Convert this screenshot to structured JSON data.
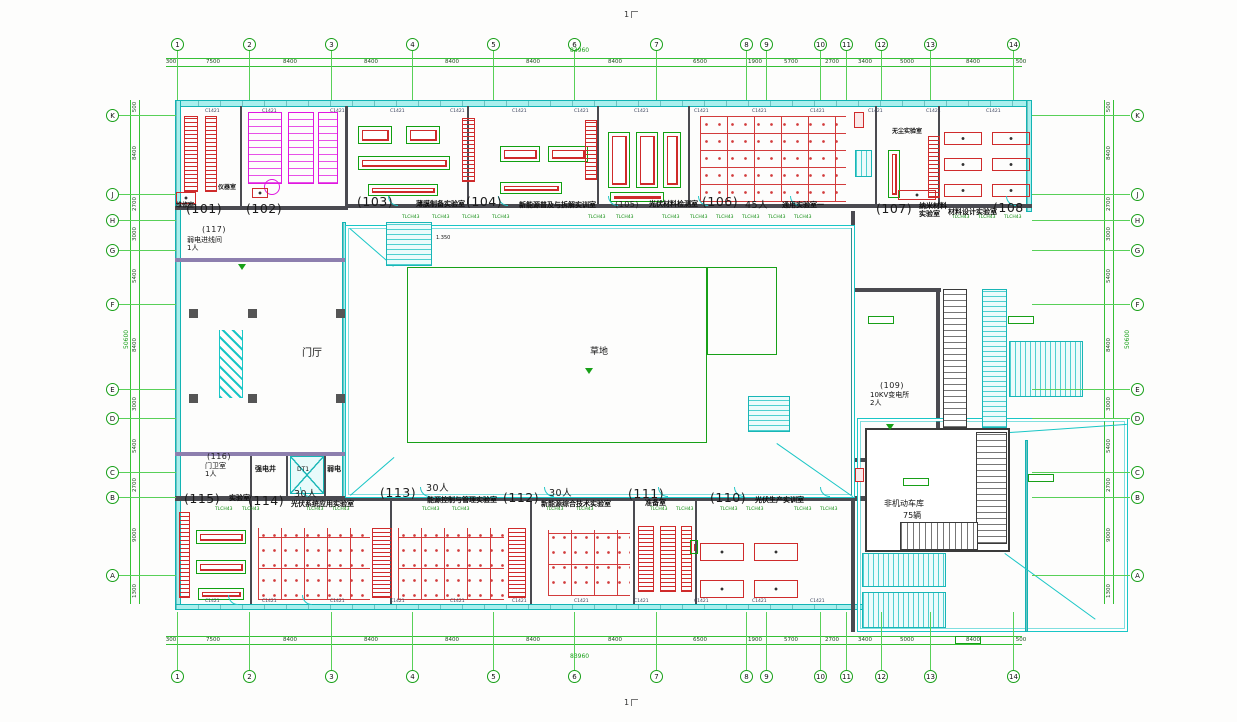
{
  "meta": {
    "sheet_mark_top": "1",
    "sheet_mark_bottom": "1"
  },
  "drawing_totals": {
    "overall_width": "83960",
    "overall_height": "50600"
  },
  "grid": {
    "top_labels": [
      "1",
      "2",
      "3",
      "4",
      "5",
      "6",
      "7",
      "8",
      "9",
      "10",
      "11",
      "12",
      "13",
      "14"
    ],
    "top_x": [
      177,
      249,
      331,
      412,
      493,
      574,
      656,
      746,
      766,
      820,
      846,
      881,
      930,
      1013
    ],
    "side_labels": [
      "K",
      "J",
      "H",
      "G",
      "F",
      "E",
      "D",
      "C",
      "B",
      "A"
    ],
    "side_y": [
      115,
      194,
      220,
      250,
      304,
      389,
      418,
      472,
      497,
      575
    ],
    "top_dims": [
      [
        "300",
        171
      ],
      [
        "7500",
        213
      ],
      [
        "8400",
        290
      ],
      [
        "8400",
        371
      ],
      [
        "8400",
        452
      ],
      [
        "8400",
        533
      ],
      [
        "8400",
        615
      ],
      [
        "6500",
        700
      ],
      [
        "1900",
        755
      ],
      [
        "5700",
        791
      ],
      [
        "2700",
        832
      ],
      [
        "3400",
        865
      ],
      [
        "5000",
        907
      ],
      [
        "8400",
        973
      ],
      [
        "500",
        1021
      ]
    ],
    "side_dims": [
      [
        "500",
        107
      ],
      [
        "8400",
        153
      ],
      [
        "2700",
        204
      ],
      [
        "3000",
        234
      ],
      [
        "5400",
        276
      ],
      [
        "8400",
        345
      ],
      [
        "3000",
        404
      ],
      [
        "5400",
        446
      ],
      [
        "2700",
        485
      ],
      [
        "9000",
        535
      ],
      [
        "1300",
        591
      ]
    ]
  },
  "rooms": [
    {
      "number": "(101)",
      "x": 186,
      "y": 201
    },
    {
      "number": "(102)",
      "x": 246,
      "y": 201
    },
    {
      "number": "(103)",
      "x": 357,
      "y": 194,
      "name": "薄膜制备实验室",
      "nx": 416,
      "ny": 201
    },
    {
      "number": "(104)",
      "x": 466,
      "y": 194,
      "name": "新能源普及与拆解实训室",
      "nx": 519,
      "ny": 202
    },
    {
      "number": "(105)",
      "x": 615,
      "y": 200,
      "small": 1,
      "name": "光伏材料检测室",
      "nx": 649,
      "ny": 201
    },
    {
      "number": "(106)",
      "x": 702,
      "y": 194,
      "persons": "45人",
      "px": 745,
      "py": 197,
      "name": "通用实验室一",
      "nx": 782,
      "ny": 202
    },
    {
      "number": "(107)",
      "x": 876,
      "y": 201,
      "name": "纳米材料\n实验室",
      "nx": 919,
      "ny": 203
    },
    {
      "number": "(108",
      "x": 993,
      "y": 200,
      "name": "材料设计实验室",
      "nx": 948,
      "ny": 209
    },
    {
      "number": "(109)",
      "x": 880,
      "y": 381,
      "small": 1,
      "nb": 1,
      "name": "10KV变电所\n2人",
      "nx": 870,
      "ny": 392
    },
    {
      "number": "(110)",
      "x": 710,
      "y": 490,
      "name": "光伏生产实训室",
      "nx": 755,
      "ny": 497
    },
    {
      "number": "(111)",
      "x": 628,
      "y": 486,
      "name": "准备室",
      "nx": 645,
      "ny": 500
    },
    {
      "number": "(112)",
      "x": 503,
      "y": 490,
      "persons": "30人",
      "px": 549,
      "py": 485,
      "name": "新能源综合技术实验室",
      "nx": 541,
      "ny": 501
    },
    {
      "number": "(113)",
      "x": 380,
      "y": 485,
      "persons": "30人",
      "px": 426,
      "py": 480,
      "name": "能源控制与管理实验室",
      "nx": 427,
      "ny": 497
    },
    {
      "number": "(114)",
      "x": 248,
      "y": 493,
      "persons": "30人",
      "px": 294,
      "py": 486,
      "name": "光伏系统应用实验室",
      "nx": 291,
      "ny": 501
    },
    {
      "number": "(115)",
      "x": 184,
      "y": 491,
      "name": "实验室",
      "nx": 229,
      "ny": 495
    },
    {
      "number": "(116)",
      "x": 207,
      "y": 452,
      "small": 1,
      "nb": 1,
      "name": "门卫室\n1人",
      "nx": 205,
      "ny": 463
    },
    {
      "number": "(117)",
      "x": 202,
      "y": 225,
      "small": 1,
      "nb": 1,
      "name": "弱电进线间\n1人",
      "nx": 187,
      "ny": 237
    }
  ],
  "labels": [
    {
      "t": "维修室",
      "x": 176,
      "y": 203,
      "s": 6,
      "b": 1
    },
    {
      "t": "仪器室",
      "x": 218,
      "y": 185,
      "s": 6,
      "b": 1
    },
    {
      "t": "1.350",
      "x": 436,
      "y": 236,
      "s": 5
    },
    {
      "t": "无尘实验室",
      "x": 892,
      "y": 129,
      "s": 6,
      "b": 1
    },
    {
      "t": "草地",
      "x": 590,
      "y": 347,
      "s": 9
    },
    {
      "t": "门厅",
      "x": 302,
      "y": 348,
      "s": 10
    },
    {
      "t": "强电井",
      "x": 255,
      "y": 465,
      "s": 7,
      "b": 1
    },
    {
      "t": "DT1",
      "x": 297,
      "y": 467,
      "s": 6
    },
    {
      "t": "弱电",
      "x": 327,
      "y": 465,
      "s": 7,
      "b": 1
    },
    {
      "t": "非机动车库",
      "x": 884,
      "y": 499,
      "s": 8
    },
    {
      "t": "75辆",
      "x": 903,
      "y": 511,
      "s": 8
    },
    {
      "t": "83960",
      "x": 570,
      "y": 48,
      "s": 6,
      "c": "g"
    },
    {
      "t": "83960",
      "x": 570,
      "y": 654,
      "s": 6,
      "c": "g"
    },
    {
      "t": "50600",
      "x": 118,
      "y": 336,
      "s": 6,
      "c": "g",
      "rot": 1
    },
    {
      "t": "50600",
      "x": 1119,
      "y": 336,
      "s": 6,
      "c": "g",
      "rot": 1
    }
  ],
  "tags": [
    {
      "t": "C1421",
      "c": "d",
      "y": 109,
      "xs": [
        205,
        262,
        330,
        390,
        450,
        512,
        574,
        634,
        694,
        752,
        810,
        868,
        926,
        986
      ]
    },
    {
      "t": "TLCH43",
      "c": "g",
      "y": 215,
      "xs": [
        402,
        432,
        462,
        492,
        588,
        616,
        662,
        690,
        716,
        742,
        768,
        794,
        952,
        978,
        1004
      ]
    },
    {
      "t": "TLCH43",
      "c": "g",
      "y": 507,
      "xs": [
        215,
        242,
        306,
        332,
        422,
        452,
        546,
        576,
        650,
        676,
        720,
        746,
        794,
        820
      ]
    },
    {
      "t": "C1421",
      "c": "d",
      "y": 599,
      "xs": [
        205,
        262,
        330,
        390,
        450,
        512,
        574,
        634,
        694,
        752,
        810
      ]
    }
  ],
  "plan": {
    "walls": [
      [
        166,
        58,
        856,
        1,
        "gl"
      ],
      [
        166,
        66,
        856,
        1,
        "gl"
      ],
      [
        166,
        636,
        856,
        1,
        "gl"
      ],
      [
        166,
        644,
        856,
        1,
        "gl"
      ],
      [
        130,
        100,
        1,
        504,
        "gl"
      ],
      [
        139,
        100,
        1,
        504,
        "gl"
      ],
      [
        1104,
        100,
        1,
        504,
        "gl"
      ],
      [
        1113,
        100,
        1,
        504,
        "gl"
      ],
      [
        175,
        100,
        857,
        7,
        "cy"
      ],
      [
        175,
        100,
        6,
        510,
        "cy"
      ],
      [
        175,
        604,
        692,
        6,
        "cy"
      ],
      [
        1026,
        100,
        6,
        112,
        "cy"
      ],
      [
        348,
        204,
        684,
        4,
        "dk"
      ],
      [
        175,
        206,
        173,
        4,
        "dk"
      ],
      [
        342,
        222,
        4,
        278,
        "cy"
      ],
      [
        175,
        258,
        170,
        4,
        "pu"
      ],
      [
        175,
        452,
        171,
        4,
        "pu"
      ],
      [
        175,
        496,
        690,
        5,
        "dk"
      ],
      [
        851,
        211,
        4,
        421,
        "dk"
      ],
      [
        851,
        288,
        90,
        4,
        "dk"
      ],
      [
        851,
        458,
        90,
        4,
        "dk"
      ],
      [
        936,
        292,
        4,
        166,
        "dk"
      ],
      [
        240,
        106,
        2,
        100,
        "dk"
      ],
      [
        345,
        106,
        3,
        100,
        "dk"
      ],
      [
        467,
        106,
        2,
        100,
        "dk"
      ],
      [
        597,
        106,
        2,
        100,
        "dk"
      ],
      [
        688,
        106,
        2,
        100,
        "dk"
      ],
      [
        875,
        106,
        2,
        100,
        "dk"
      ],
      [
        938,
        106,
        2,
        100,
        "dk"
      ],
      [
        250,
        501,
        2,
        103,
        "dk"
      ],
      [
        390,
        501,
        2,
        103,
        "dk"
      ],
      [
        530,
        501,
        2,
        103,
        "dk"
      ],
      [
        633,
        501,
        2,
        103,
        "dk"
      ],
      [
        695,
        501,
        2,
        103,
        "dk"
      ],
      [
        250,
        456,
        2,
        40,
        "dk"
      ],
      [
        286,
        456,
        2,
        40,
        "dk"
      ],
      [
        324,
        456,
        2,
        40,
        "dk"
      ],
      [
        865,
        428,
        145,
        124,
        "dkbox"
      ],
      [
        857,
        418,
        271,
        214,
        "cybox"
      ],
      [
        1025,
        440,
        3,
        192,
        "cy"
      ],
      [
        345,
        225,
        510,
        273,
        "cybox"
      ],
      [
        407,
        267,
        300,
        176,
        "gnbox"
      ],
      [
        707,
        267,
        70,
        88,
        "gnbox"
      ]
    ],
    "diags": [
      {
        "x": 350,
        "y": 228,
        "len": 58,
        "rot": 41
      },
      {
        "x": 350,
        "y": 495,
        "len": 58,
        "rot": -41
      },
      {
        "x": 777,
        "y": 443,
        "len": 93,
        "rot": 35
      },
      {
        "x": 1005,
        "y": 553,
        "len": 112,
        "rot": 36
      },
      {
        "x": 1010,
        "y": 432,
        "len": 117,
        "rot": -4
      }
    ],
    "furniture": [
      [
        "rackv",
        184,
        116,
        14,
        76
      ],
      [
        "rackv",
        205,
        116,
        12,
        76
      ],
      [
        "benchr",
        176,
        192,
        20,
        12
      ],
      [
        "wc",
        248,
        112,
        34,
        72
      ],
      [
        "wc",
        288,
        112,
        26,
        72
      ],
      [
        "wc",
        318,
        112,
        20,
        72
      ],
      [
        "wcc",
        264,
        179,
        16,
        16
      ],
      [
        "benchr",
        252,
        188,
        16,
        10
      ],
      [
        "benchg",
        358,
        126,
        34,
        18
      ],
      [
        "benchg",
        406,
        126,
        34,
        18
      ],
      [
        "benchg",
        358,
        156,
        92,
        14
      ],
      [
        "benchg",
        368,
        184,
        70,
        12
      ],
      [
        "rackv",
        462,
        118,
        13,
        64
      ],
      [
        "benchg",
        500,
        146,
        40,
        16
      ],
      [
        "benchg",
        548,
        146,
        40,
        16
      ],
      [
        "benchg",
        500,
        182,
        62,
        12
      ],
      [
        "rackv",
        585,
        120,
        12,
        60
      ],
      [
        "benchg",
        608,
        132,
        22,
        56
      ],
      [
        "benchg",
        636,
        132,
        22,
        56
      ],
      [
        "benchg",
        663,
        132,
        18,
        56
      ],
      [
        "benchg",
        610,
        192,
        54,
        10
      ],
      [
        "desks",
        700,
        116,
        146,
        86
      ],
      [
        "redbox",
        854,
        112,
        10,
        16
      ],
      [
        "benchg",
        888,
        150,
        12,
        48
      ],
      [
        "rackv",
        928,
        136,
        12,
        62
      ],
      [
        "benchr",
        898,
        190,
        38,
        10
      ],
      [
        "benchr",
        944,
        132,
        38,
        13
      ],
      [
        "benchr",
        992,
        132,
        38,
        13
      ],
      [
        "benchr",
        944,
        158,
        38,
        13
      ],
      [
        "benchr",
        992,
        158,
        38,
        13
      ],
      [
        "benchr",
        944,
        184,
        38,
        13
      ],
      [
        "benchr",
        992,
        184,
        38,
        13
      ],
      [
        "rackv",
        179,
        512,
        11,
        86
      ],
      [
        "benchg",
        196,
        530,
        50,
        14
      ],
      [
        "benchg",
        196,
        560,
        50,
        14
      ],
      [
        "benchg",
        198,
        588,
        46,
        12
      ],
      [
        "desksv",
        258,
        528,
        112,
        72
      ],
      [
        "rack",
        372,
        528,
        20,
        70
      ],
      [
        "desksv",
        398,
        528,
        106,
        72
      ],
      [
        "rack",
        508,
        528,
        18,
        70
      ],
      [
        "desksv",
        548,
        530,
        82,
        66
      ],
      [
        "rack",
        638,
        526,
        16,
        66
      ],
      [
        "rack",
        660,
        526,
        16,
        66
      ],
      [
        "rack",
        681,
        526,
        11,
        66
      ],
      [
        "benchr",
        700,
        543,
        44,
        18
      ],
      [
        "benchr",
        754,
        543,
        44,
        18
      ],
      [
        "benchr",
        700,
        580,
        44,
        18
      ],
      [
        "benchr",
        754,
        580,
        44,
        18
      ],
      [
        "benchg",
        690,
        540,
        8,
        14
      ],
      [
        "col",
        189,
        309,
        9,
        9
      ],
      [
        "col",
        248,
        309,
        9,
        9
      ],
      [
        "col",
        336,
        309,
        9,
        9
      ],
      [
        "col",
        189,
        394,
        9,
        9
      ],
      [
        "col",
        248,
        394,
        9,
        9
      ],
      [
        "col",
        336,
        394,
        9,
        9
      ],
      [
        "zig",
        219,
        330,
        24,
        68
      ],
      [
        "stairh",
        386,
        222,
        46,
        44
      ],
      [
        "stairv",
        855,
        150,
        17,
        27
      ],
      [
        "stairh",
        748,
        396,
        42,
        36
      ],
      [
        "rampd",
        943,
        289,
        24,
        139
      ],
      [
        "rampc",
        982,
        289,
        25,
        139
      ],
      [
        "stairv2",
        1009,
        341,
        74,
        56
      ],
      [
        "rampd",
        976,
        432,
        31,
        112
      ],
      [
        "rampdh",
        900,
        522,
        78,
        28
      ],
      [
        "rampc2",
        862,
        553,
        84,
        34
      ],
      [
        "rampc2",
        862,
        592,
        84,
        36
      ],
      [
        "lift",
        290,
        456,
        34,
        38
      ],
      [
        "redbox",
        855,
        468,
        9,
        14
      ],
      [
        "tri",
        585,
        368,
        8,
        6
      ],
      [
        "tri",
        238,
        264,
        8,
        6
      ],
      [
        "tri",
        886,
        424,
        8,
        6
      ],
      [
        "gbox",
        903,
        478,
        26,
        8
      ],
      [
        "gbox",
        1028,
        474,
        26,
        8
      ],
      [
        "gbox",
        955,
        636,
        26,
        8
      ],
      [
        "gbox",
        1008,
        316,
        26,
        8
      ],
      [
        "gbox",
        868,
        316,
        26,
        8
      ]
    ],
    "arcs": [
      [
        388,
        196
      ],
      [
        498,
        196
      ],
      [
        608,
        196
      ],
      [
        698,
        196
      ],
      [
        790,
        196
      ],
      [
        1006,
        196
      ],
      [
        300,
        487
      ],
      [
        420,
        487
      ],
      [
        544,
        487
      ],
      [
        658,
        487
      ],
      [
        734,
        487
      ],
      [
        820,
        487
      ],
      [
        228,
        595
      ],
      [
        302,
        595
      ]
    ]
  }
}
